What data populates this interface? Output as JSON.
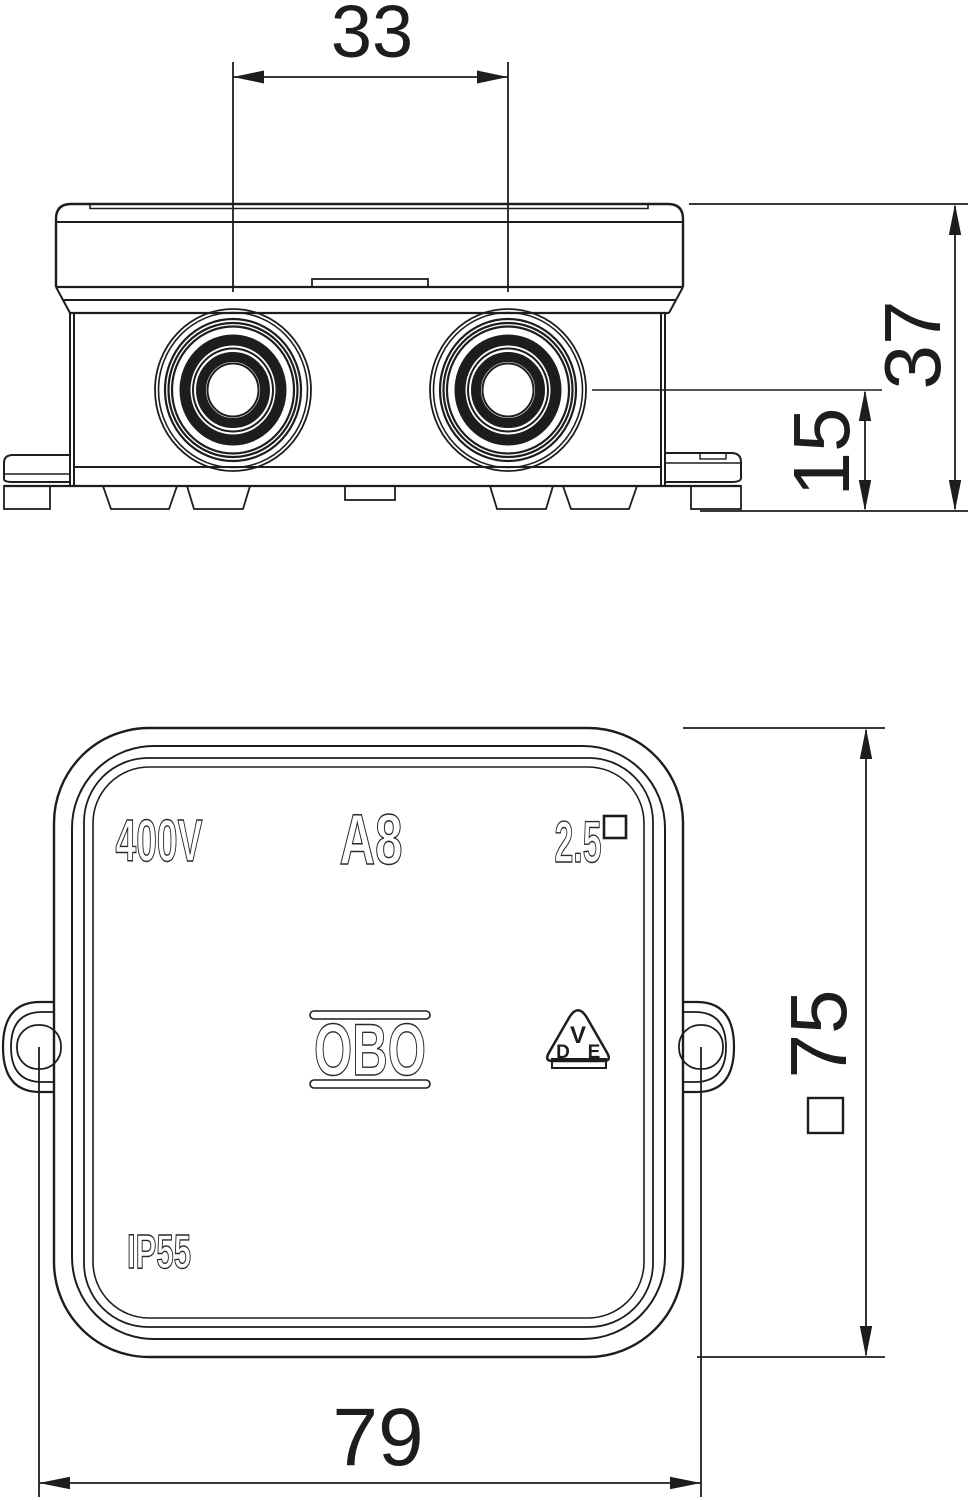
{
  "drawing": {
    "title": "junction-box dimensional drawing",
    "ink_color": "#1d1d1d",
    "background": "#ffffff"
  },
  "dimensions": {
    "entry_spacing": "33",
    "total_height": "37",
    "entry_center_height": "15",
    "body_square": "75",
    "overall_width": "79"
  },
  "markings": {
    "voltage": "400V",
    "model": "A8",
    "wire_gauge": "2.5",
    "ip_rating": "IP55",
    "brand": "OBO",
    "vde_v": "V",
    "vde_d": "D",
    "vde_e": "E"
  }
}
